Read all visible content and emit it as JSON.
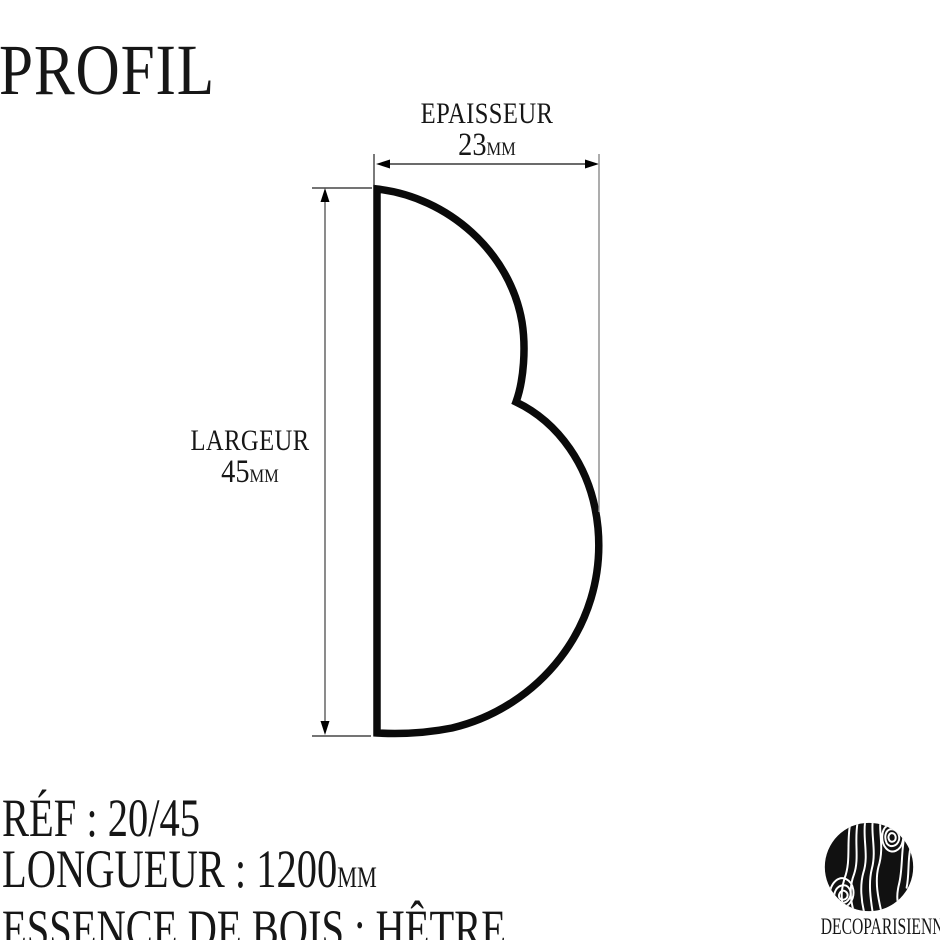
{
  "page": {
    "background_color": "#ffffff",
    "ink_color": "#161616",
    "line_color": "#555555"
  },
  "title": "PROFIL",
  "drawing": {
    "thickness": {
      "label": "EPAISSEUR",
      "value": "23",
      "unit": "MM"
    },
    "width": {
      "label": "LARGEUR",
      "value": "45",
      "unit": "MM"
    },
    "shape": "moulding-profile-double-bump"
  },
  "specs": {
    "separator": " : ",
    "ref": {
      "label": "RÉF",
      "value": "20/45"
    },
    "longueur": {
      "label": "LONGUEUR",
      "value": "1200",
      "unit": "MM"
    },
    "essence": {
      "label": "ESSENCE DE BOIS",
      "value": "HÊTRE"
    }
  },
  "logo": {
    "wordmark": "DECOPARISIENNE",
    "icon": "wood-grain-circle",
    "icon_color": "#111111"
  }
}
